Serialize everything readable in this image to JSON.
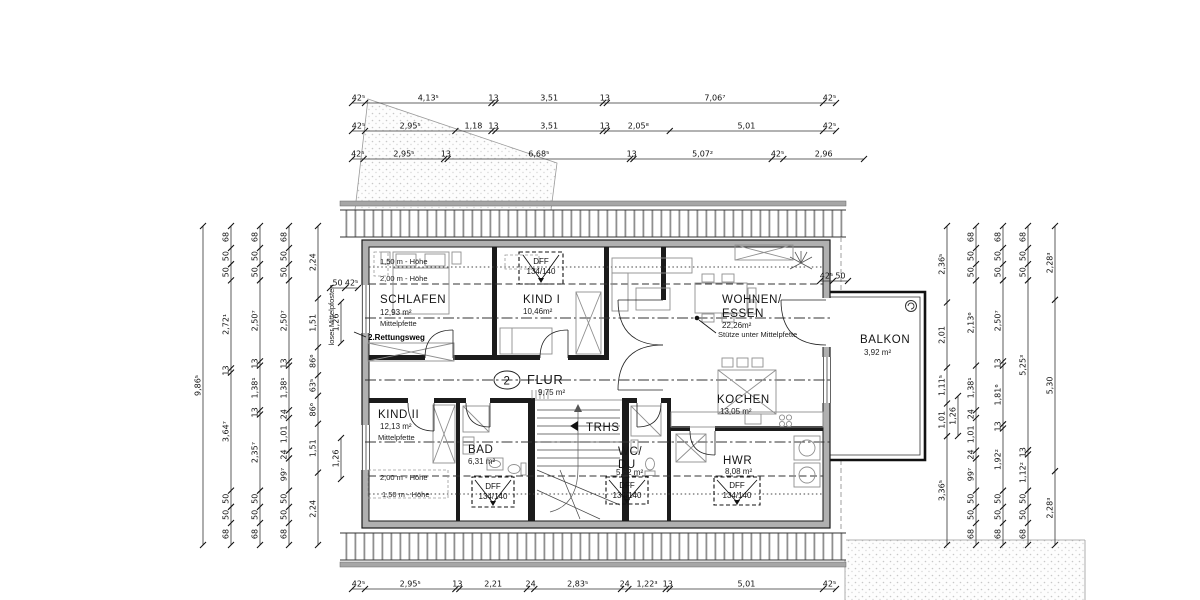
{
  "rooms": {
    "schlafen": {
      "name": "SCHLAFEN",
      "area": "12,93 m²"
    },
    "kind1": {
      "name": "KIND I",
      "area": "10,46m²"
    },
    "wohnen": {
      "name_line1": "WOHNEN/",
      "name_line2": "ESSEN",
      "area": "22,26m²"
    },
    "kind2": {
      "name": "KIND II",
      "area": "12,13 m²"
    },
    "bad": {
      "name": "BAD",
      "area": "6,31 m²"
    },
    "trhs": {
      "name": "TRHS"
    },
    "wcdu": {
      "name_line1": "WC/",
      "name_line2": "DU",
      "area": "5,62 m²"
    },
    "kochen": {
      "name": "KOCHEN",
      "area": "13,05 m²"
    },
    "hwr": {
      "name": "HWR",
      "area": "8,08 m²"
    },
    "flur": {
      "name": "FLUR",
      "area": "9,75 m²",
      "number": "2"
    },
    "balkon": {
      "name": "BALKON",
      "area": "3,92 m²"
    }
  },
  "annotations": {
    "hoehe_150_top": "1,50 m - Höhe",
    "hoehe_200_top": "2,00 m - Höhe",
    "hoehe_200_bottom": "2,00 m - Höhe",
    "hoehe_150_bottom": "1,50 m - Höhe",
    "mittelpfette_top": "Mittelpfette",
    "mittelpfette_bottom": "Mittelpfette",
    "rettungsweg": "2.Rettungsweg",
    "stuetze": "Stütze unter Mittelpfette",
    "loser_mittelpfosten": "loser Mittelpfosten",
    "dff_label": "DFF",
    "dff_size": "134/140"
  },
  "colors": {
    "wall_dark": "#1b1b1b",
    "wall_gray": "#b0b0b0",
    "stipple": "#cccccc",
    "line": "#333333"
  },
  "dimensions": {
    "chains": [
      {
        "id": "top-row-1",
        "dir": "h",
        "pos": 103,
        "from": 352,
        "to": 836,
        "values": [
          "42⁵",
          "4,13⁵",
          "13",
          "3,51",
          "13",
          "7,06⁷",
          "42⁵"
        ],
        "lens": [
          0.425,
          4.135,
          0.13,
          3.51,
          0.13,
          7.067,
          0.425
        ]
      },
      {
        "id": "top-row-2",
        "dir": "h",
        "pos": 131,
        "from": 352,
        "to": 836,
        "values": [
          "42⁵",
          "2,95⁵",
          "1,18",
          "13",
          "3,51",
          "13",
          "2,05⁸",
          "5,01",
          "42⁵"
        ],
        "lens": [
          0.425,
          2.955,
          1.18,
          0.13,
          3.51,
          0.13,
          2.058,
          5.01,
          0.425
        ]
      },
      {
        "id": "top-row-3",
        "dir": "h",
        "pos": 159,
        "from": 352,
        "to": 864,
        "values": [
          "42⁵",
          "2,95⁵",
          "13",
          "6,68⁵",
          "13",
          "5,07²",
          "42⁵",
          "2,96"
        ],
        "lens": [
          0.425,
          2.955,
          0.13,
          6.685,
          0.13,
          5.072,
          0.425,
          2.96
        ]
      },
      {
        "id": "bottom-row",
        "dir": "h",
        "pos": 589,
        "from": 352,
        "to": 836,
        "values": [
          "42⁵",
          "2,95⁵",
          "13",
          "2,21",
          "24",
          "2,83⁵",
          "24",
          "1,22³",
          "13",
          "5,01",
          "42⁵"
        ],
        "lens": [
          0.425,
          2.955,
          0.13,
          2.21,
          0.24,
          2.835,
          0.24,
          1.223,
          0.13,
          5.01,
          0.425
        ]
      },
      {
        "id": "left-1",
        "dir": "v",
        "pos": 203,
        "from": 226,
        "to": 545,
        "values": [
          "9,86⁵"
        ],
        "lens": [
          9.865
        ]
      },
      {
        "id": "left-2",
        "dir": "v",
        "pos": 231,
        "from": 226,
        "to": 545,
        "values": [
          "68",
          "50",
          "50",
          "2,72¹",
          "13",
          "3,64⁷",
          "50",
          "50",
          "68"
        ],
        "lens": [
          0.68,
          0.5,
          0.5,
          2.721,
          0.13,
          3.647,
          0.5,
          0.5,
          0.68
        ]
      },
      {
        "id": "left-3",
        "dir": "v",
        "pos": 260,
        "from": 226,
        "to": 545,
        "values": [
          "68",
          "50",
          "50",
          "2,50⁷",
          "13",
          "1,38¹",
          "13",
          "2,35⁷",
          "50",
          "50",
          "68"
        ],
        "lens": [
          0.68,
          0.5,
          0.5,
          2.507,
          0.13,
          1.381,
          0.13,
          2.357,
          0.5,
          0.5,
          0.68
        ]
      },
      {
        "id": "left-4",
        "dir": "v",
        "pos": 289,
        "from": 226,
        "to": 545,
        "values": [
          "68",
          "50",
          "50",
          "2,50⁷",
          "13",
          "1,38¹",
          "24",
          "1,01",
          "24",
          "99⁷",
          "50",
          "50",
          "68"
        ],
        "lens": [
          0.68,
          0.5,
          0.5,
          2.507,
          0.13,
          1.381,
          0.24,
          1.01,
          0.24,
          0.997,
          0.5,
          0.5,
          0.68
        ]
      },
      {
        "id": "left-5",
        "dir": "v",
        "pos": 318,
        "from": 226,
        "to": 545,
        "values": [
          "2,24",
          "1,51",
          "86⁶",
          "63⁵",
          "86⁶",
          "1,51",
          "2,24"
        ],
        "lens": [
          2.24,
          1.51,
          0.866,
          0.635,
          0.866,
          1.51,
          2.24
        ]
      },
      {
        "id": "left-inner-upper",
        "dir": "v",
        "pos": 341,
        "from": 302,
        "to": 343,
        "values": [
          "1,26"
        ],
        "lens": [
          1.26
        ]
      },
      {
        "id": "left-inner-lower",
        "dir": "v",
        "pos": 341,
        "from": 438,
        "to": 479,
        "values": [
          "1,26"
        ],
        "lens": [
          1.26
        ]
      },
      {
        "id": "right-1",
        "dir": "v",
        "pos": 947,
        "from": 226,
        "to": 545,
        "values": [
          "2,36⁵",
          "2,01",
          "1,11⁵",
          "1,01",
          "3,36⁵"
        ],
        "lens": [
          2.365,
          2.01,
          1.115,
          1.01,
          3.365
        ]
      },
      {
        "id": "right-2",
        "dir": "v",
        "pos": 976,
        "from": 226,
        "to": 545,
        "values": [
          "68",
          "50",
          "50",
          "2,13⁶",
          "1,38¹",
          "24",
          "1,01",
          "24",
          "99⁷",
          "50",
          "50",
          "68"
        ],
        "lens": [
          0.68,
          0.5,
          0.5,
          2.636,
          1.381,
          0.24,
          1.01,
          0.24,
          0.997,
          0.5,
          0.5,
          0.68
        ]
      },
      {
        "id": "right-3",
        "dir": "v",
        "pos": 1003,
        "from": 226,
        "to": 545,
        "values": [
          "68",
          "50",
          "50",
          "2,50⁷",
          "13",
          "1,81⁶",
          "13",
          "1,92²",
          "50",
          "50",
          "68"
        ],
        "lens": [
          0.68,
          0.5,
          0.5,
          2.507,
          0.13,
          1.816,
          0.13,
          1.922,
          0.5,
          0.5,
          0.68
        ]
      },
      {
        "id": "right-4",
        "dir": "v",
        "pos": 1028,
        "from": 226,
        "to": 545,
        "values": [
          "68",
          "50",
          "50",
          "5,25³",
          "13",
          "1,12²",
          "50",
          "50",
          "68"
        ],
        "lens": [
          0.68,
          0.5,
          0.5,
          5.253,
          0.13,
          1.122,
          0.5,
          0.5,
          0.68
        ]
      },
      {
        "id": "right-5",
        "dir": "v",
        "pos": 1055,
        "from": 226,
        "to": 545,
        "values": [
          "2,28³",
          "5,30",
          "2,28³"
        ],
        "lens": [
          2.283,
          5.3,
          2.283
        ]
      },
      {
        "id": "right-inner",
        "dir": "v",
        "pos": 958,
        "from": 396,
        "to": 436,
        "values": [
          "1,26"
        ],
        "lens": [
          1.26
        ]
      },
      {
        "id": "corner-left",
        "dir": "h",
        "pos": 288,
        "from": 330,
        "to": 358,
        "values": [
          "50",
          "42⁵"
        ],
        "lens": [
          0.5,
          0.425
        ]
      },
      {
        "id": "corner-right",
        "dir": "h",
        "pos": 281,
        "from": 820,
        "to": 848,
        "values": [
          "42⁵",
          "50"
        ],
        "lens": [
          0.425,
          0.5
        ]
      }
    ]
  }
}
